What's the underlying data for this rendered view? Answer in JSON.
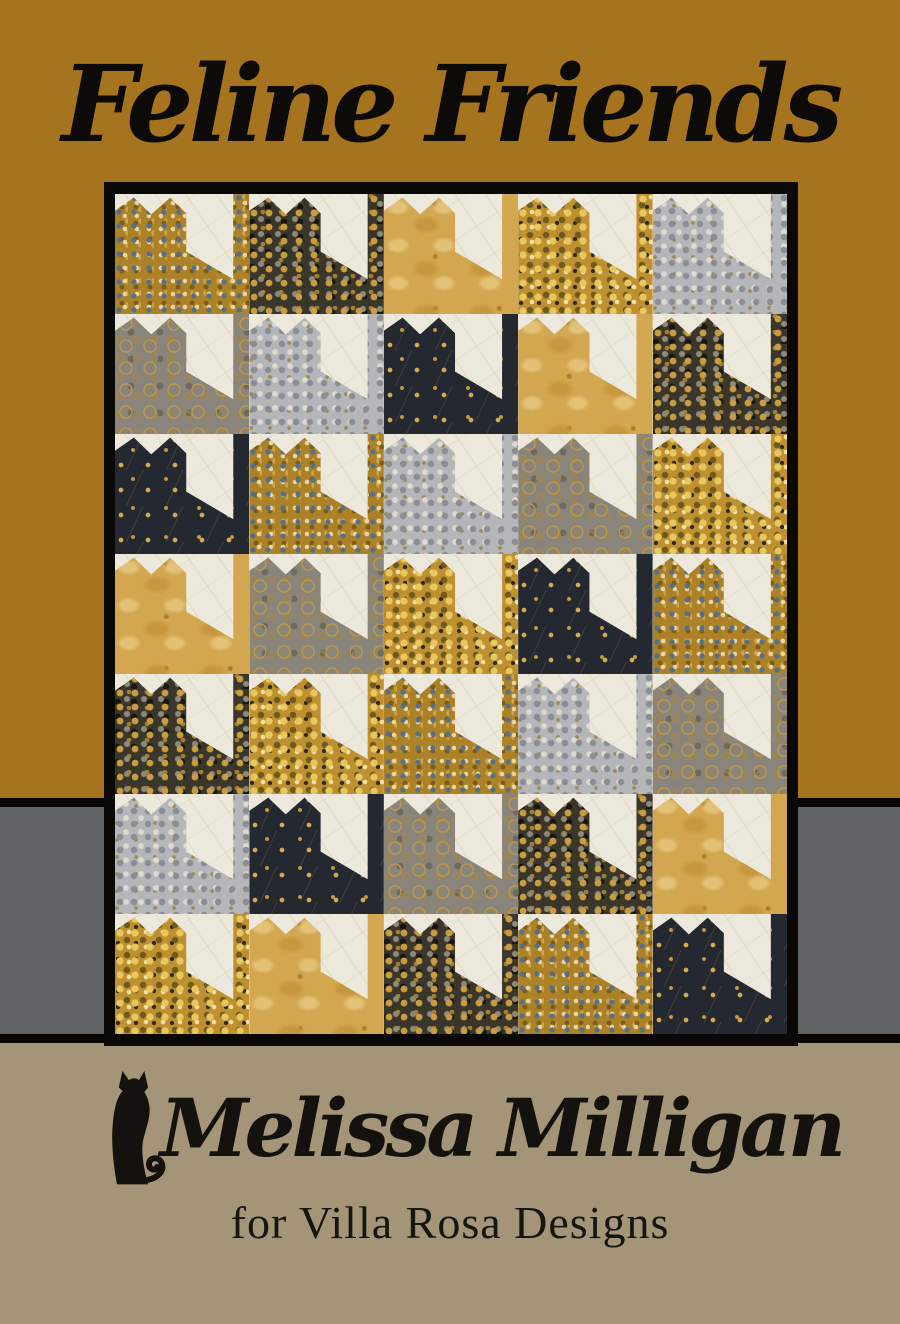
{
  "title": "Feline Friends",
  "designer": "Melissa Milligan",
  "credit": "for Villa Rosa Designs",
  "colors": {
    "background_gold": "#a6741f",
    "band_gray": "#616263",
    "band_tan": "#a59578",
    "frame_black": "#0a0908",
    "text_black": "#0c0b09",
    "quilt_cream": "#ece8db"
  },
  "icons": {
    "cat_logo": "sitting-cat-silhouette-icon"
  },
  "quilt": {
    "rows": 7,
    "cols": 5,
    "block_style": "sitting cat seen from behind: eared head at left, back sloping down to a full-height tail strip at right, on cream background",
    "fabrics": {
      "gold-floral": {
        "label": "gold with blue floral dots",
        "base": "#ac8229"
      },
      "black-pebble": {
        "label": "charcoal with gold pebbles",
        "base": "#3a362b"
      },
      "tan": {
        "label": "mottled light gold",
        "base": "#d3a750"
      },
      "gold-pebble": {
        "label": "rich gold pebbles",
        "base": "#bf9030"
      },
      "silver-pebble": {
        "label": "silver gray pebbles",
        "base": "#b5b6b9"
      },
      "gray-swirl": {
        "label": "gray with gold swirls",
        "base": "#8a857c"
      },
      "black-tri": {
        "label": "black with gold triangles",
        "base": "#242830"
      }
    },
    "grid": [
      [
        "gold-floral",
        "black-pebble",
        "tan",
        "gold-pebble",
        "silver-pebble"
      ],
      [
        "gray-swirl",
        "silver-pebble",
        "black-tri",
        "tan",
        "black-pebble"
      ],
      [
        "black-tri",
        "gold-floral",
        "silver-pebble",
        "gray-swirl",
        "gold-pebble"
      ],
      [
        "tan",
        "gray-swirl",
        "gold-pebble",
        "black-tri",
        "gold-floral"
      ],
      [
        "black-pebble",
        "gold-pebble",
        "gold-floral",
        "silver-pebble",
        "gray-swirl"
      ],
      [
        "silver-pebble",
        "black-tri",
        "gray-swirl",
        "black-pebble",
        "tan"
      ],
      [
        "gold-pebble",
        "tan",
        "black-pebble",
        "gold-floral",
        "black-tri"
      ]
    ]
  }
}
